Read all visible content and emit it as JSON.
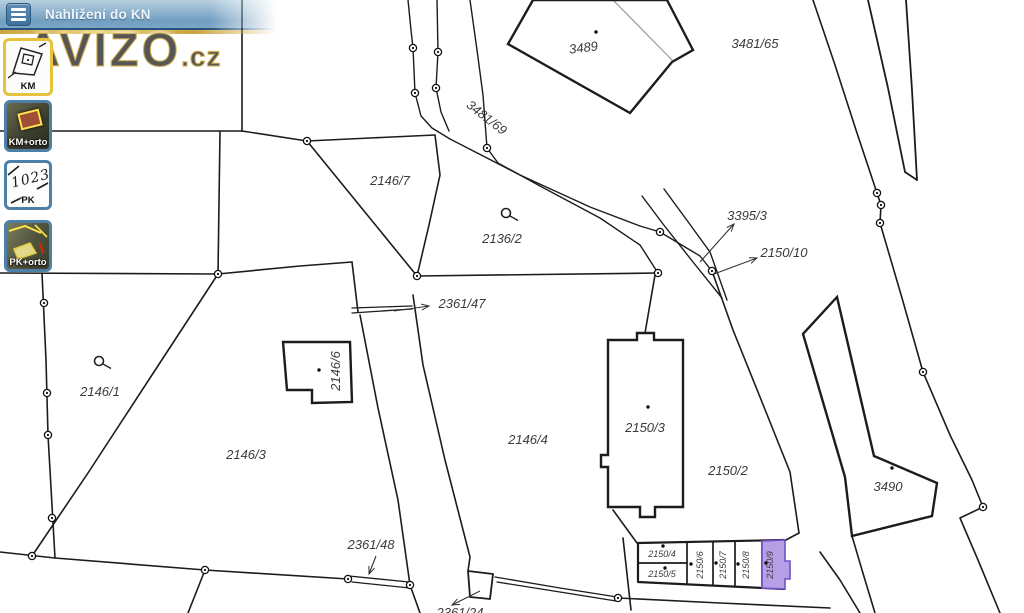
{
  "header": {
    "title": "Nahlížení do KN"
  },
  "watermark": {
    "brand": "AVIZO",
    "tld": ".cz"
  },
  "sidebar": {
    "buttons": [
      {
        "id": "km",
        "label": "KM",
        "selected": true
      },
      {
        "id": "km-orto",
        "label": "KM+orto",
        "selected": false
      },
      {
        "id": "pk",
        "label": "PK",
        "selected": false,
        "icon_text": "1023"
      },
      {
        "id": "pk-orto",
        "label": "PK+orto",
        "selected": false
      }
    ]
  },
  "theme": {
    "line_color": "#1c1c1c",
    "label_color": "#3b3b3b",
    "highlight_fill": "#b79fe6",
    "highlight_stroke": "#7050c8",
    "selected_border": "#e7c33c",
    "button_border": "#4e7fa6",
    "header_blue": "#7fa9c9"
  },
  "map": {
    "highlight": {
      "parcel": "2150/9",
      "pts": "762,541 785,540 785,561 790,561 790,579 785,579 785,589 762,588"
    },
    "labels": [
      {
        "t": "3489",
        "x": 584,
        "y": 52,
        "r": -7
      },
      {
        "t": "3481/65",
        "x": 755,
        "y": 48
      },
      {
        "t": "3481/69",
        "x": 484,
        "y": 121,
        "r": 38
      },
      {
        "t": "2146/7",
        "x": 390,
        "y": 185
      },
      {
        "t": "2136/2",
        "x": 502,
        "y": 243
      },
      {
        "t": "3395/3",
        "x": 747,
        "y": 220
      },
      {
        "t": "2150/10",
        "x": 784,
        "y": 257
      },
      {
        "t": "2361/47",
        "x": 462,
        "y": 308
      },
      {
        "t": "2146/1",
        "x": 100,
        "y": 396
      },
      {
        "t": "2146/6",
        "x": 340,
        "y": 371,
        "r": -90
      },
      {
        "t": "2146/4",
        "x": 528,
        "y": 444
      },
      {
        "t": "2150/3",
        "x": 645,
        "y": 432
      },
      {
        "t": "2150/2",
        "x": 728,
        "y": 475
      },
      {
        "t": "3490",
        "x": 888,
        "y": 491
      },
      {
        "t": "2146/3",
        "x": 246,
        "y": 459
      },
      {
        "t": "2361/48",
        "x": 371,
        "y": 549
      },
      {
        "t": "2150/4",
        "x": 662,
        "y": 557,
        "s": 9
      },
      {
        "t": "2150/5",
        "x": 662,
        "y": 577,
        "s": 9
      },
      {
        "t": "2150/6",
        "x": 703,
        "y": 565,
        "r": -90,
        "s": 9
      },
      {
        "t": "2150/7",
        "x": 726,
        "y": 565,
        "r": -90,
        "s": 9
      },
      {
        "t": "2150/8",
        "x": 749,
        "y": 565,
        "r": -90,
        "s": 9
      },
      {
        "t": "2150/9",
        "x": 773,
        "y": 565,
        "r": -90,
        "s": 9
      },
      {
        "t": "2361/24",
        "x": 460,
        "y": 617
      }
    ],
    "buildings": [
      {
        "pts": "508,44 533,0 667,0 693,50 672,62 630,113"
      },
      {
        "pts": "283,342 350,342 352,402 312,403 312,390 287,390"
      },
      {
        "pts": "608,340 637,340 637,333 654,333 654,340 683,340 683,507 655,507 655,517 640,517 640,507 608,507 608,467 601,467 601,455 608,455"
      },
      {
        "pts": "837,297 803,334 845,477 852,536 932,516 937,483 874,456"
      }
    ],
    "polylines": [
      {
        "pts": "242,0 242,131"
      },
      {
        "pts": "0,131 242,131"
      },
      {
        "pts": "220,131 218,274"
      },
      {
        "pts": "0,273 218,274"
      },
      {
        "pts": "218,274 300,266 352,262"
      },
      {
        "pts": "352,262 358,312"
      },
      {
        "pts": "218,274 150,378 88,473 32,556"
      },
      {
        "pts": "42,273 46,360 48,435 55,558"
      },
      {
        "pts": "0,552 55,558 205,570 348,579"
      },
      {
        "pts": "205,570 188,613"
      },
      {
        "pts": "349,576 409,582",
        "w": 1.3
      },
      {
        "pts": "352,582 410,588",
        "w": 1.3
      },
      {
        "pts": "410,585 420,613"
      },
      {
        "pts": "360,315 378,408 398,500 410,585"
      },
      {
        "pts": "413,295 423,365 445,460 470,557 468,571"
      },
      {
        "pts": "352,308 412,306",
        "w": 1.3
      },
      {
        "pts": "352,313 412,309",
        "w": 1.3
      },
      {
        "pts": "242,131 307,141 370,138 435,135"
      },
      {
        "pts": "307,141 417,276"
      },
      {
        "pts": "435,135 440,175 429,225 417,276"
      },
      {
        "pts": "417,276 658,273"
      },
      {
        "pts": "408,0 411,30 413,48 415,93 421,116 432,128 450,139 520,175 590,207 640,226 660,232 700,256 712,271",
        "w": 1.4
      },
      {
        "pts": "437,0 438,52 436,88 441,112 449,131",
        "w": 1.4
      },
      {
        "pts": "470,0 477,50 483,95 487,148 498,163 540,186 600,218 640,245 658,273",
        "w": 1.4
      },
      {
        "pts": "655,275 645,333"
      },
      {
        "pts": "642,196 663,224 693,262 722,298",
        "w": 1.4
      },
      {
        "pts": "664,189 686,219 710,252 727,300",
        "w": 1.4
      },
      {
        "pts": "712,271 733,330 762,402 790,472 799,533"
      },
      {
        "pts": "784,541 799,533"
      },
      {
        "pts": "613,510 637,543"
      },
      {
        "pts": "623,538 631,610"
      },
      {
        "pts": "495,577 560,588 617,597",
        "w": 1.3
      },
      {
        "pts": "497,582 560,592 616,601",
        "w": 1.3
      },
      {
        "pts": "618,598 720,603 830,608"
      },
      {
        "pts": "852,536 862,570 875,613"
      },
      {
        "pts": "820,552 840,580 860,613"
      },
      {
        "pts": "813,0 834,62 856,130 877,193 881,205 880,223 902,298 923,372 950,435 972,480 983,507"
      },
      {
        "pts": "983,507 960,518 978,560 1000,613"
      },
      {
        "pts": "868,0 888,88 905,172",
        "w": 1.8
      },
      {
        "pts": "906,0 912,90 917,180",
        "w": 1.8
      },
      {
        "pts": "905,172 917,180",
        "w": 1.8
      },
      {
        "pts": "468,571 493,574 490,599 470,597 468,571",
        "w": 1.8
      },
      {
        "pts": "613,0 672,60",
        "c": "#9a9a9a",
        "w": 1.2
      },
      {
        "pts": "638,543 784,540 784,589 638,582 638,543",
        "w": 2.2
      },
      {
        "pts": "687,542 687,583",
        "w": 1.7
      },
      {
        "pts": "713,542 713,585",
        "w": 1.7
      },
      {
        "pts": "735,542 735,586",
        "w": 1.7
      },
      {
        "pts": "762,541 762,588",
        "w": 1.7
      },
      {
        "pts": "638,563 687,563",
        "w": 1.7
      }
    ],
    "circles": [
      [
        413,
        48
      ],
      [
        415,
        93
      ],
      [
        438,
        52
      ],
      [
        436,
        88
      ],
      [
        487,
        148
      ],
      [
        307,
        141
      ],
      [
        417,
        276
      ],
      [
        660,
        232
      ],
      [
        658,
        273
      ],
      [
        712,
        271
      ],
      [
        218,
        274
      ],
      [
        44,
        303
      ],
      [
        47,
        393
      ],
      [
        48,
        435
      ],
      [
        52,
        518
      ],
      [
        32,
        556
      ],
      [
        205,
        570
      ],
      [
        348,
        579
      ],
      [
        410,
        585
      ],
      [
        618,
        598
      ],
      [
        877,
        193
      ],
      [
        881,
        205
      ],
      [
        880,
        223
      ],
      [
        923,
        372
      ],
      [
        983,
        507
      ]
    ],
    "dots": [
      [
        596,
        32
      ],
      [
        319,
        370
      ],
      [
        648,
        407
      ],
      [
        892,
        468
      ],
      [
        663,
        546
      ],
      [
        665,
        568
      ],
      [
        691,
        564
      ],
      [
        716,
        563
      ],
      [
        738,
        564
      ],
      [
        766,
        563
      ]
    ],
    "arrows": [
      {
        "x1": 700,
        "y1": 262,
        "x2": 734,
        "y2": 224
      },
      {
        "x1": 714,
        "y1": 274,
        "x2": 757,
        "y2": 258
      },
      {
        "x1": 394,
        "y1": 311,
        "x2": 429,
        "y2": 306
      },
      {
        "x1": 376,
        "y1": 556,
        "x2": 369,
        "y2": 574
      },
      {
        "x1": 480,
        "y1": 591,
        "x2": 452,
        "y2": 605
      }
    ],
    "symbols": [
      {
        "x": 99,
        "y": 361
      },
      {
        "x": 506,
        "y": 213
      }
    ]
  }
}
